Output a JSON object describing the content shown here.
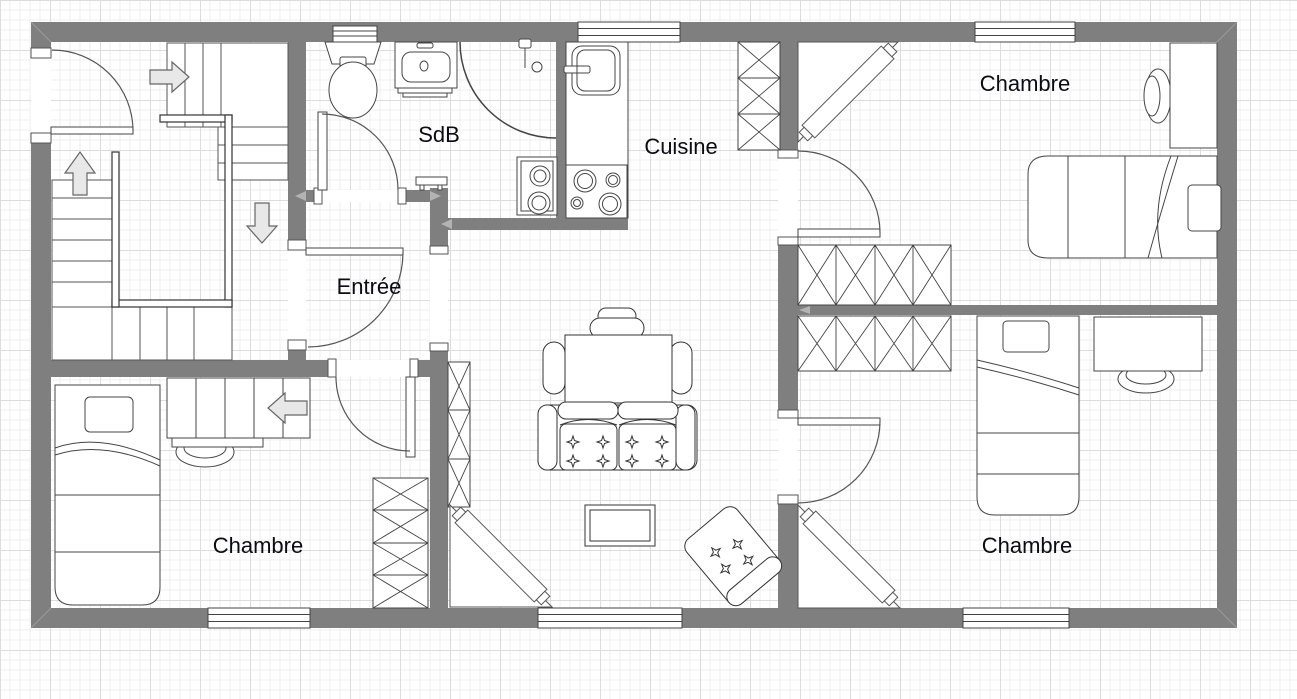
{
  "canvas": {
    "width": 1297,
    "height": 699,
    "grid_minor_px": 10,
    "grid_major_px": 50
  },
  "colors": {
    "background": "#ffffff",
    "grid_minor": "#efefef",
    "grid_major": "#dcdcdc",
    "wall": "#7f7f7f",
    "furniture_stroke": "#444444",
    "door_arc": "#555555",
    "arrow_fill": "#e8e8e8",
    "arrow_stroke": "#666666",
    "label_text": "#0b0b14"
  },
  "rooms": [
    {
      "id": "sdb",
      "label": "SdB"
    },
    {
      "id": "cuisine",
      "label": "Cuisine"
    },
    {
      "id": "entree",
      "label": "Entrée"
    },
    {
      "id": "chambre-nord-est",
      "label": "Chambre"
    },
    {
      "id": "chambre-sud-ouest",
      "label": "Chambre"
    },
    {
      "id": "chambre-sud-est",
      "label": "Chambre"
    }
  ]
}
